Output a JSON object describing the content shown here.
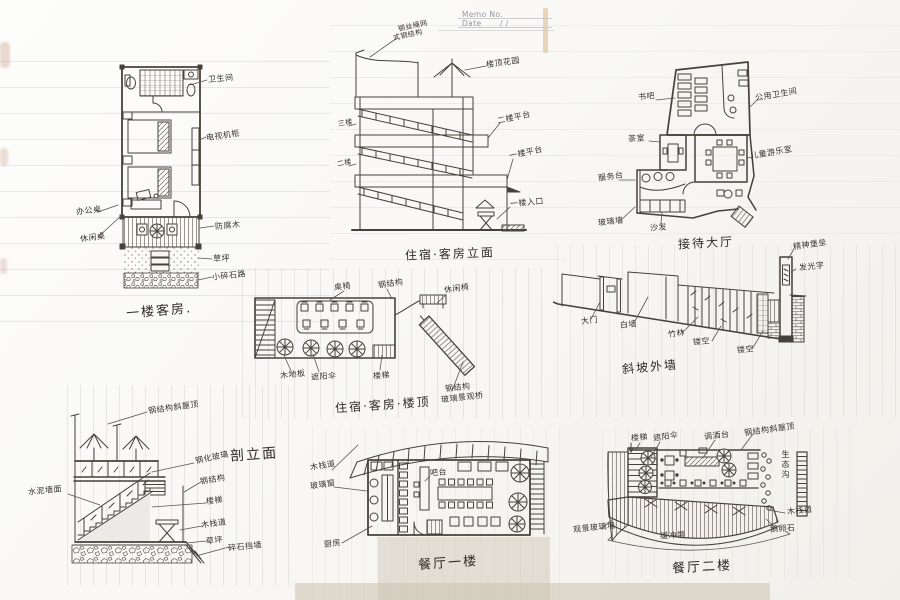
{
  "memo": {
    "no_label": "Memo No.",
    "date_label": "Date",
    "date_value": "/      /"
  },
  "drawings": {
    "guest_room_plan": {
      "title": "一楼客房.",
      "labels": {
        "bathroom": "卫生间",
        "tv_cabinet": "电视机柜",
        "desk": "办公桌",
        "leisure_table": "休闲桌",
        "preserved_wood": "防腐木",
        "lawn": "草坪",
        "gravel_path": "小碎石路"
      }
    },
    "guesthouse_elevation": {
      "title": "住宿·客房立面",
      "labels": {
        "steel_wire_line1": "钢丝绳网",
        "steel_wire_line2": "式钢结构",
        "roof_garden": "楼顶花园",
        "floor3": "三楼",
        "floor2": "二楼",
        "platform2": "二楼平台",
        "platform1": "一楼平台",
        "entrance": "一楼入口"
      }
    },
    "reception_plan": {
      "title": "接待大厅",
      "labels": {
        "book_bar": "书吧",
        "public_wc": "公用卫生间",
        "tea_room": "茶室",
        "kids_room": "儿童游乐室",
        "service_desk": "服务台",
        "glass_wall": "玻璃墙",
        "sofa": "沙发"
      }
    },
    "roof_plan": {
      "title": "住宿·客房·楼顶",
      "labels": {
        "tables": "桌椅",
        "steel_structure": "钢结构",
        "leisure_chair": "休闲椅",
        "wood_deck": "木地板",
        "parasol": "遮阳伞",
        "stairs": "楼梯",
        "bridge_line1": "钢结构",
        "bridge_line2": "玻璃景观桥"
      }
    },
    "outer_wall": {
      "title": "斜坡外墙",
      "labels": {
        "gate": "大门",
        "white_wall": "白墙",
        "bamboo": "竹林",
        "hollow_1": "镂空",
        "hollow_2": "镂空",
        "spirit_tower": "精神堡垒",
        "glow_sign": "发光字"
      }
    },
    "section": {
      "title": "剖立面",
      "labels": {
        "steel_roof": "钢结构斜屋顶",
        "cement_wall": "水泥墙面",
        "tempered_glass": "钢化玻璃",
        "steel_structure": "钢结构",
        "stairs": "楼梯",
        "boardwalk": "木栈道",
        "lawn": "草坪",
        "stone_wall": "碎石挡墙"
      }
    },
    "restaurant_f1": {
      "title": "餐厅一楼",
      "labels": {
        "boardwalk": "木栈道",
        "glass_window": "玻璃窗",
        "kitchen": "厨房",
        "bar": "吧台"
      }
    },
    "restaurant_f2": {
      "title": "餐厅二楼",
      "labels": {
        "stairs": "楼梯",
        "parasol": "遮阳伞",
        "bar": "调酒台",
        "steel_roof": "钢结构斜屋顶",
        "eco_ditch": "生态沟",
        "boardwalk": "木栈道",
        "cobbles": "鹅卵石",
        "view_glass_wall": "观景玻璃墙",
        "buffer_zone": "缓冲带"
      }
    }
  }
}
